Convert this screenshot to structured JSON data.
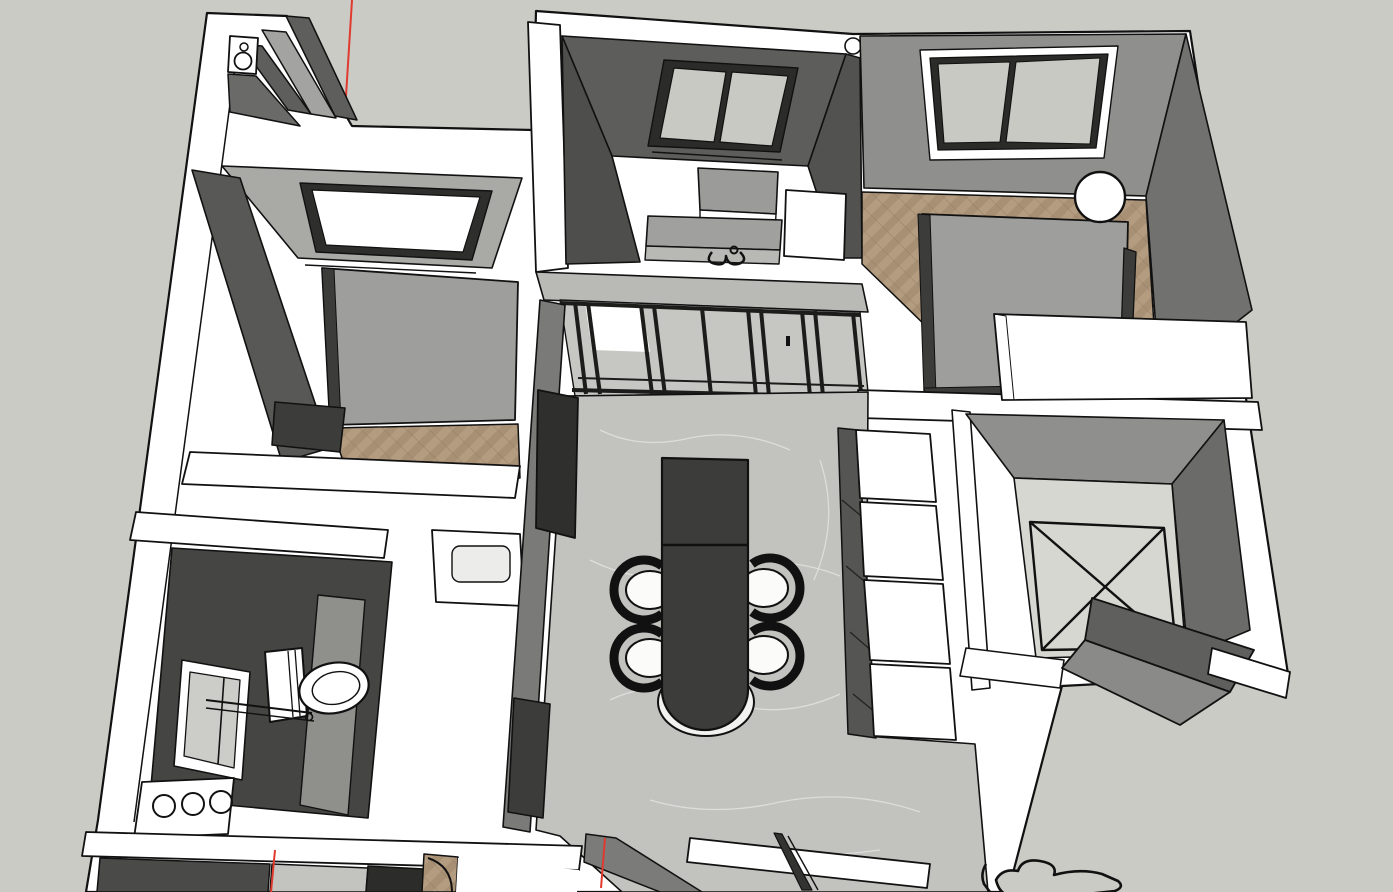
{
  "scene": {
    "description": "3D modeling viewport (SketchUp-style) showing an apartment floor-plan model viewed from above in perspective; white sectioned walls, gray feature walls, marble and herringbone wood floors, red drawing axis line, neutral gray ground",
    "view": "top-down perspective cutaway",
    "app_hint": "3d-model-viewport"
  },
  "colors": {
    "background": "#cbcbc5",
    "wall_white": "#ffffff",
    "wall_top_light": "#b9b9b6",
    "wall_face_gray": "#8f8f8d",
    "wall_face_mid": "#7a7a78",
    "wall_face_dark": "#5e5e5c",
    "charcoal": "#454543",
    "concrete": "#5d5d5b",
    "floor_marble": "#c2c2bf",
    "marble_vein": "#e4e4e1",
    "floor_wood": "#b49c80",
    "floor_wood_dark": "#9c8468",
    "floor_light": "#d7d7d2",
    "furniture_dark": "#3c3c3a",
    "furniture_gray": "#9e9e9c",
    "glass": "#c9c9c4",
    "seat_white": "#fbfbfa",
    "edge": "#111111",
    "axis_red": "#e03a2f"
  },
  "rooms": [
    {
      "id": "laundry-nook",
      "label": "Laundry nook with top-load washer"
    },
    {
      "id": "entry-hall",
      "label": "Entry hall"
    },
    {
      "id": "bedroom-left",
      "label": "Left bedroom — bed, wardrobe, nightstand, window, herringbone wood floor"
    },
    {
      "id": "kitchen",
      "label": "Kitchen — window, island, sink counter with faucet, fridge, glass sliding partition"
    },
    {
      "id": "bedroom-right",
      "label": "Right bedroom — bed, sphere lamp, white desk, window, herringbone wood floor"
    },
    {
      "id": "living-dining",
      "label": "Living / dining room — marble floor, dark dining table, four chairs, TV panel, white cabinet run"
    },
    {
      "id": "bathroom",
      "label": "Bathroom — toilet, window, vanity counter with three round basins"
    },
    {
      "id": "shaft",
      "label": "Void / shaft room with X-marked floor"
    },
    {
      "id": "lower-rooms",
      "label": "Lower rooms cut by viewport edge — dark media wall, doorway arc, marble hall"
    },
    {
      "id": "outside",
      "label": "Exterior ground with porch slab and sketch outline"
    }
  ],
  "furniture": {
    "washer": "top-load washing machine",
    "bed_left": "double bed",
    "nightstand": "nightstand",
    "basin": "wash basin counter",
    "window_left": "bedroom window",
    "kitchen_window": "kitchen window",
    "island": "kitchen island",
    "sink_counter": "sink counter with faucet",
    "fridge": "refrigerator",
    "partition": "black-framed glass sliding partition",
    "bed_right": "double bed",
    "lamp": "sphere pendant lamp",
    "desk": "white desk",
    "door_leaf": "open door leaf",
    "tv_panel": "wall TV panel",
    "dining_table": "dark dining table with rounded end",
    "chair": "dining chair with white seat",
    "cabinets": "white cabinet run",
    "tall_cabinet": "dark tall cabinet",
    "toilet": "toilet",
    "vanity": "vanity with three round basins",
    "bath_window": "bathroom window",
    "shaft_floor": "X-marked shaft floor",
    "porch_slab": "exterior porch slab",
    "sketch": "unfinished 2D sketch outline",
    "axis": "red drawing axis"
  }
}
